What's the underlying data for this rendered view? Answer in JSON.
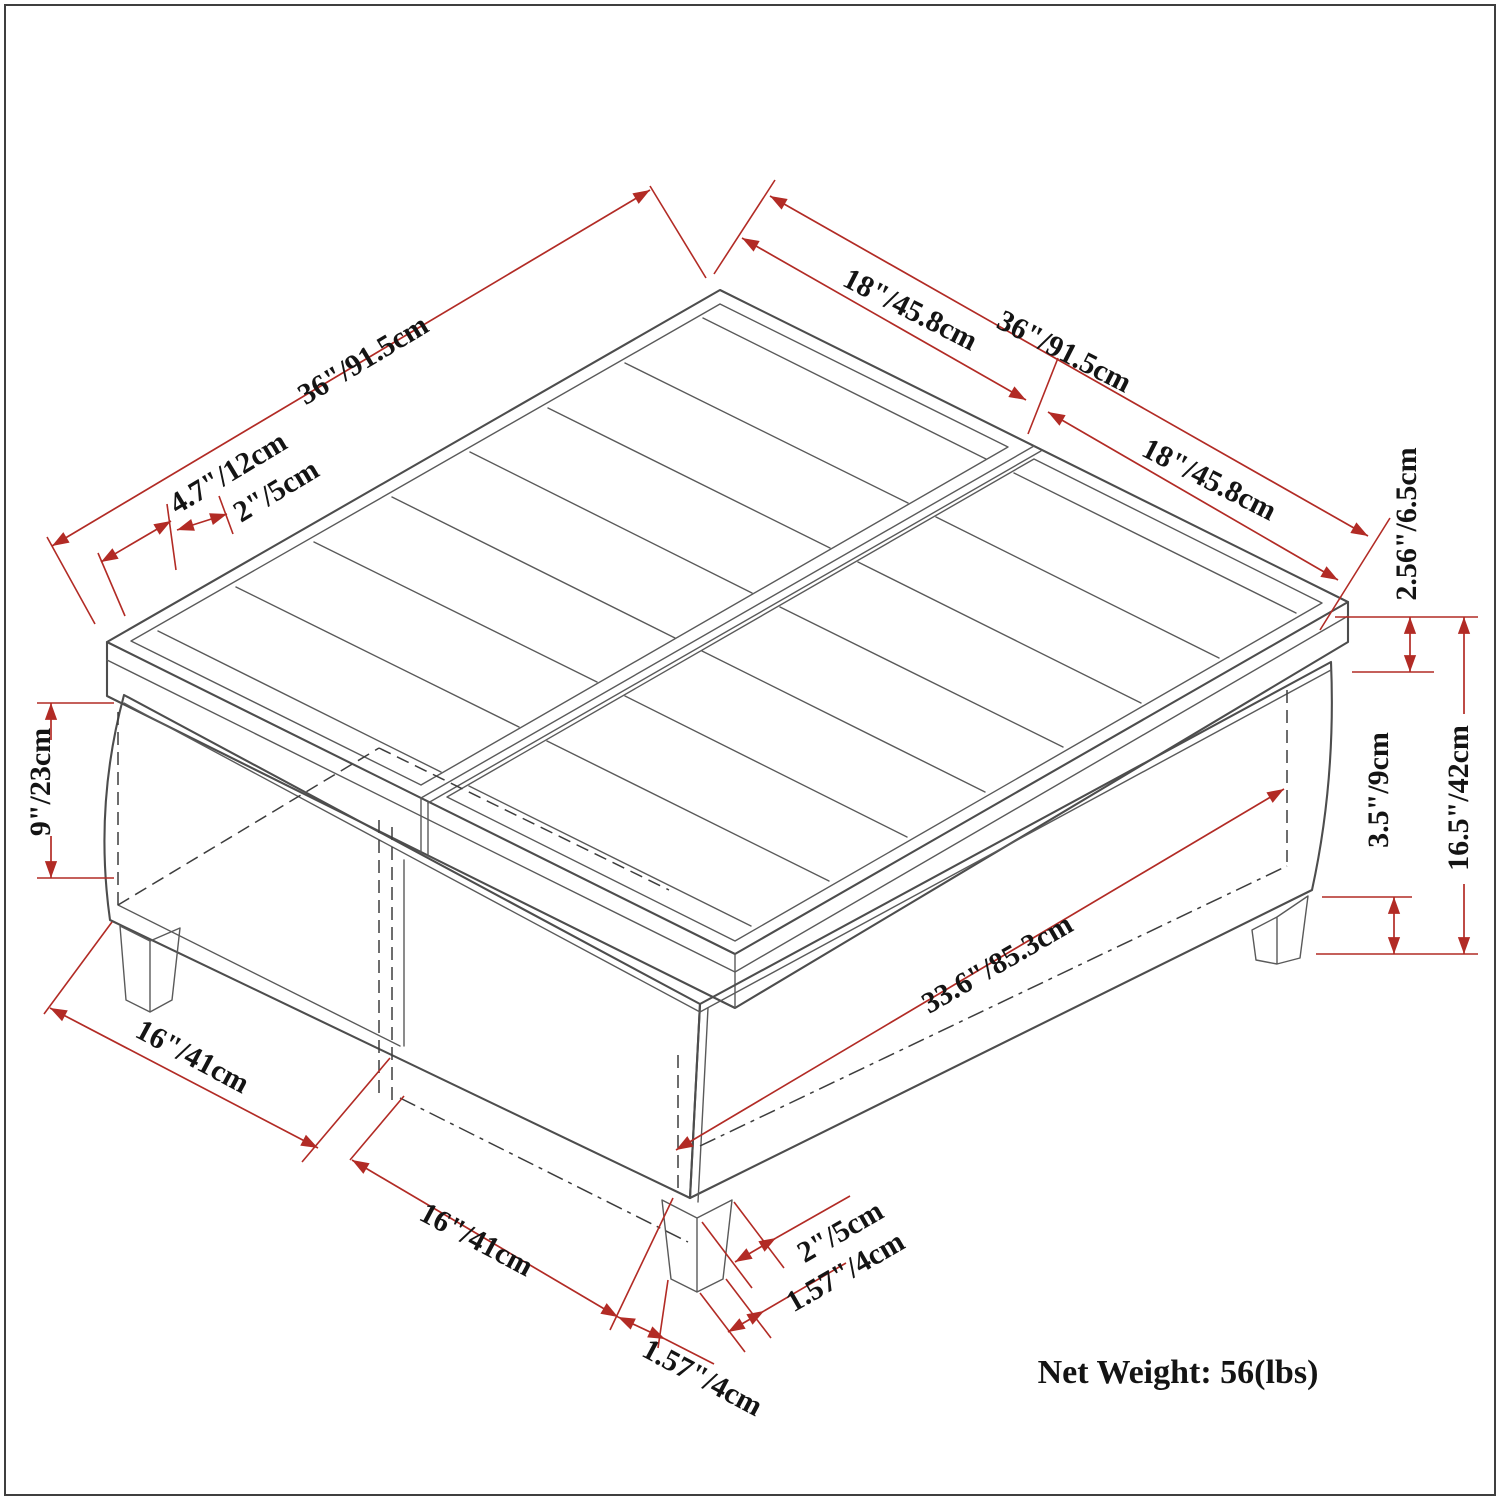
{
  "diagram": {
    "type": "isometric-dimension-drawing",
    "subject": "storage ottoman coffee table with open shelf and split cushion top",
    "background": "#ffffff",
    "colors": {
      "dimension_lines": "#b22b25",
      "drawing_lines": "#4d4d4d",
      "hidden_lines": "#3d3d3d",
      "text": "#141414"
    },
    "net_weight": "Net Weight: 56(lbs)",
    "labels": [
      {
        "id": "top-left-width",
        "text": "36\"/91.5cm"
      },
      {
        "id": "channel-width",
        "text": "4.7\"/12cm"
      },
      {
        "id": "edge-border",
        "text": "2\"/5cm"
      },
      {
        "id": "back-right-half-1",
        "text": "18\"/45.8cm"
      },
      {
        "id": "top-right-width",
        "text": "36\"/91.5cm"
      },
      {
        "id": "back-right-half-2",
        "text": "18\"/45.8cm"
      },
      {
        "id": "cushion-thickness",
        "text": "2.56\"/6.5cm"
      },
      {
        "id": "total-height",
        "text": "16.5\"/42cm"
      },
      {
        "id": "leg-height",
        "text": "3.5\"/9cm"
      },
      {
        "id": "opening-height",
        "text": "9\"/23cm"
      },
      {
        "id": "compartment-width-1",
        "text": "16\"/41cm"
      },
      {
        "id": "compartment-width-2",
        "text": "16\"/41cm"
      },
      {
        "id": "interior-width",
        "text": "33.6\"/85.3cm"
      },
      {
        "id": "leg-top-width",
        "text": "2\"/5cm"
      },
      {
        "id": "leg-inset-right",
        "text": "1.57\"/4cm"
      },
      {
        "id": "leg-inset-left",
        "text": "1.57\"/4cm"
      }
    ]
  }
}
